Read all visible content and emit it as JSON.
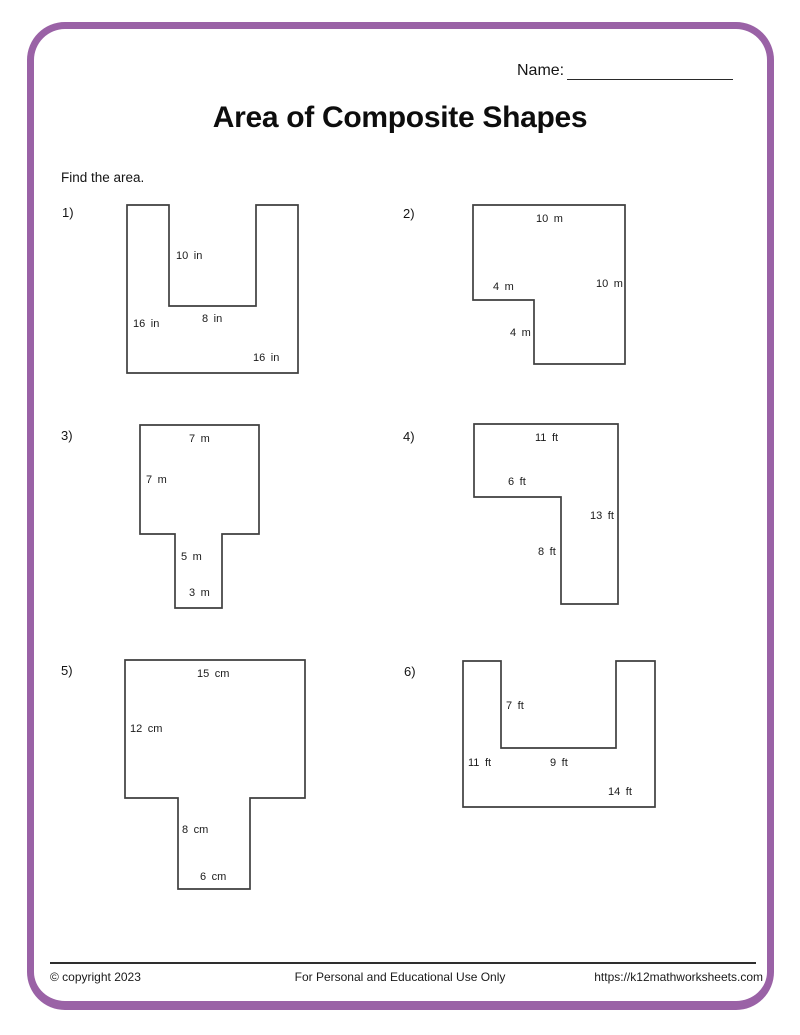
{
  "header": {
    "name_label": "Name:",
    "title": "Area of Composite Shapes",
    "instruction": "Find the area."
  },
  "problems": [
    {
      "number": "1)",
      "shape": "u-shape",
      "labels": [
        "10 in",
        "8 in",
        "16 in",
        "16 in"
      ]
    },
    {
      "number": "2)",
      "shape": "l-shape",
      "labels": [
        "10 m",
        "4 m",
        "10 m",
        "4 m"
      ]
    },
    {
      "number": "3)",
      "shape": "t-shape",
      "labels": [
        "7 m",
        "7 m",
        "5 m",
        "3 m"
      ]
    },
    {
      "number": "4)",
      "shape": "l-shape",
      "labels": [
        "11 ft",
        "6 ft",
        "13 ft",
        "8 ft"
      ]
    },
    {
      "number": "5)",
      "shape": "t-shape",
      "labels": [
        "15 cm",
        "12 cm",
        "8 cm",
        "6 cm"
      ]
    },
    {
      "number": "6)",
      "shape": "u-shape",
      "labels": [
        "7 ft",
        "9 ft",
        "11 ft",
        "14 ft"
      ]
    }
  ],
  "footer": {
    "copyright": "© copyright 2023",
    "usage": "For Personal and Educational Use Only",
    "website": "https://k12mathworksheets.com"
  },
  "colors": {
    "page_border": "#9a62a6",
    "shape_stroke": "#3f3f3f",
    "text": "#1f1f1f"
  }
}
